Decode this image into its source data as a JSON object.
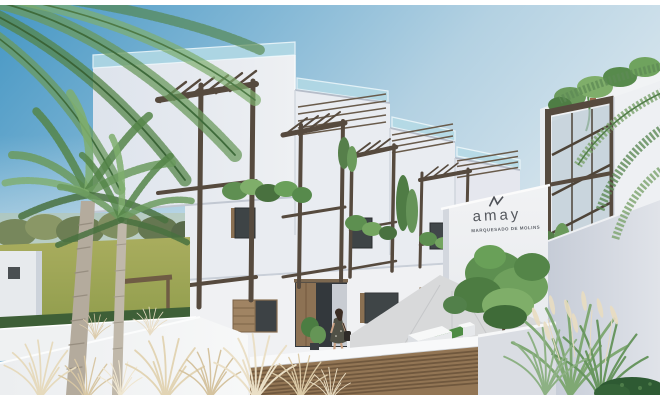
{
  "image": {
    "alt": "New-build white Mediterranean townhouses with dark wooden pergolas, rooftop glass railings, palm trees, a woman at the entrance and a landscaped courtyard with ornamental grasses"
  },
  "sign": {
    "brand": "amay",
    "project": "MARQUESADO DE MOLINS"
  },
  "palette": {
    "sky_left": "#4697c4",
    "sky_right": "#d9e7ef",
    "wall_bright": "#f1f2f4",
    "wall_light": "#e9ecf1",
    "wall_shadow": "#c6ccd7",
    "glass_railing": "#b5dbe6",
    "pergola_wood": "#564a3e",
    "garage_door_wood": "#8f7254",
    "foliage_green": "#5d8f50",
    "meadow_green": "#9aa455",
    "pavement": "#d8d9da",
    "dry_grass": "#e6dabd",
    "sign_text": "#54575d"
  }
}
